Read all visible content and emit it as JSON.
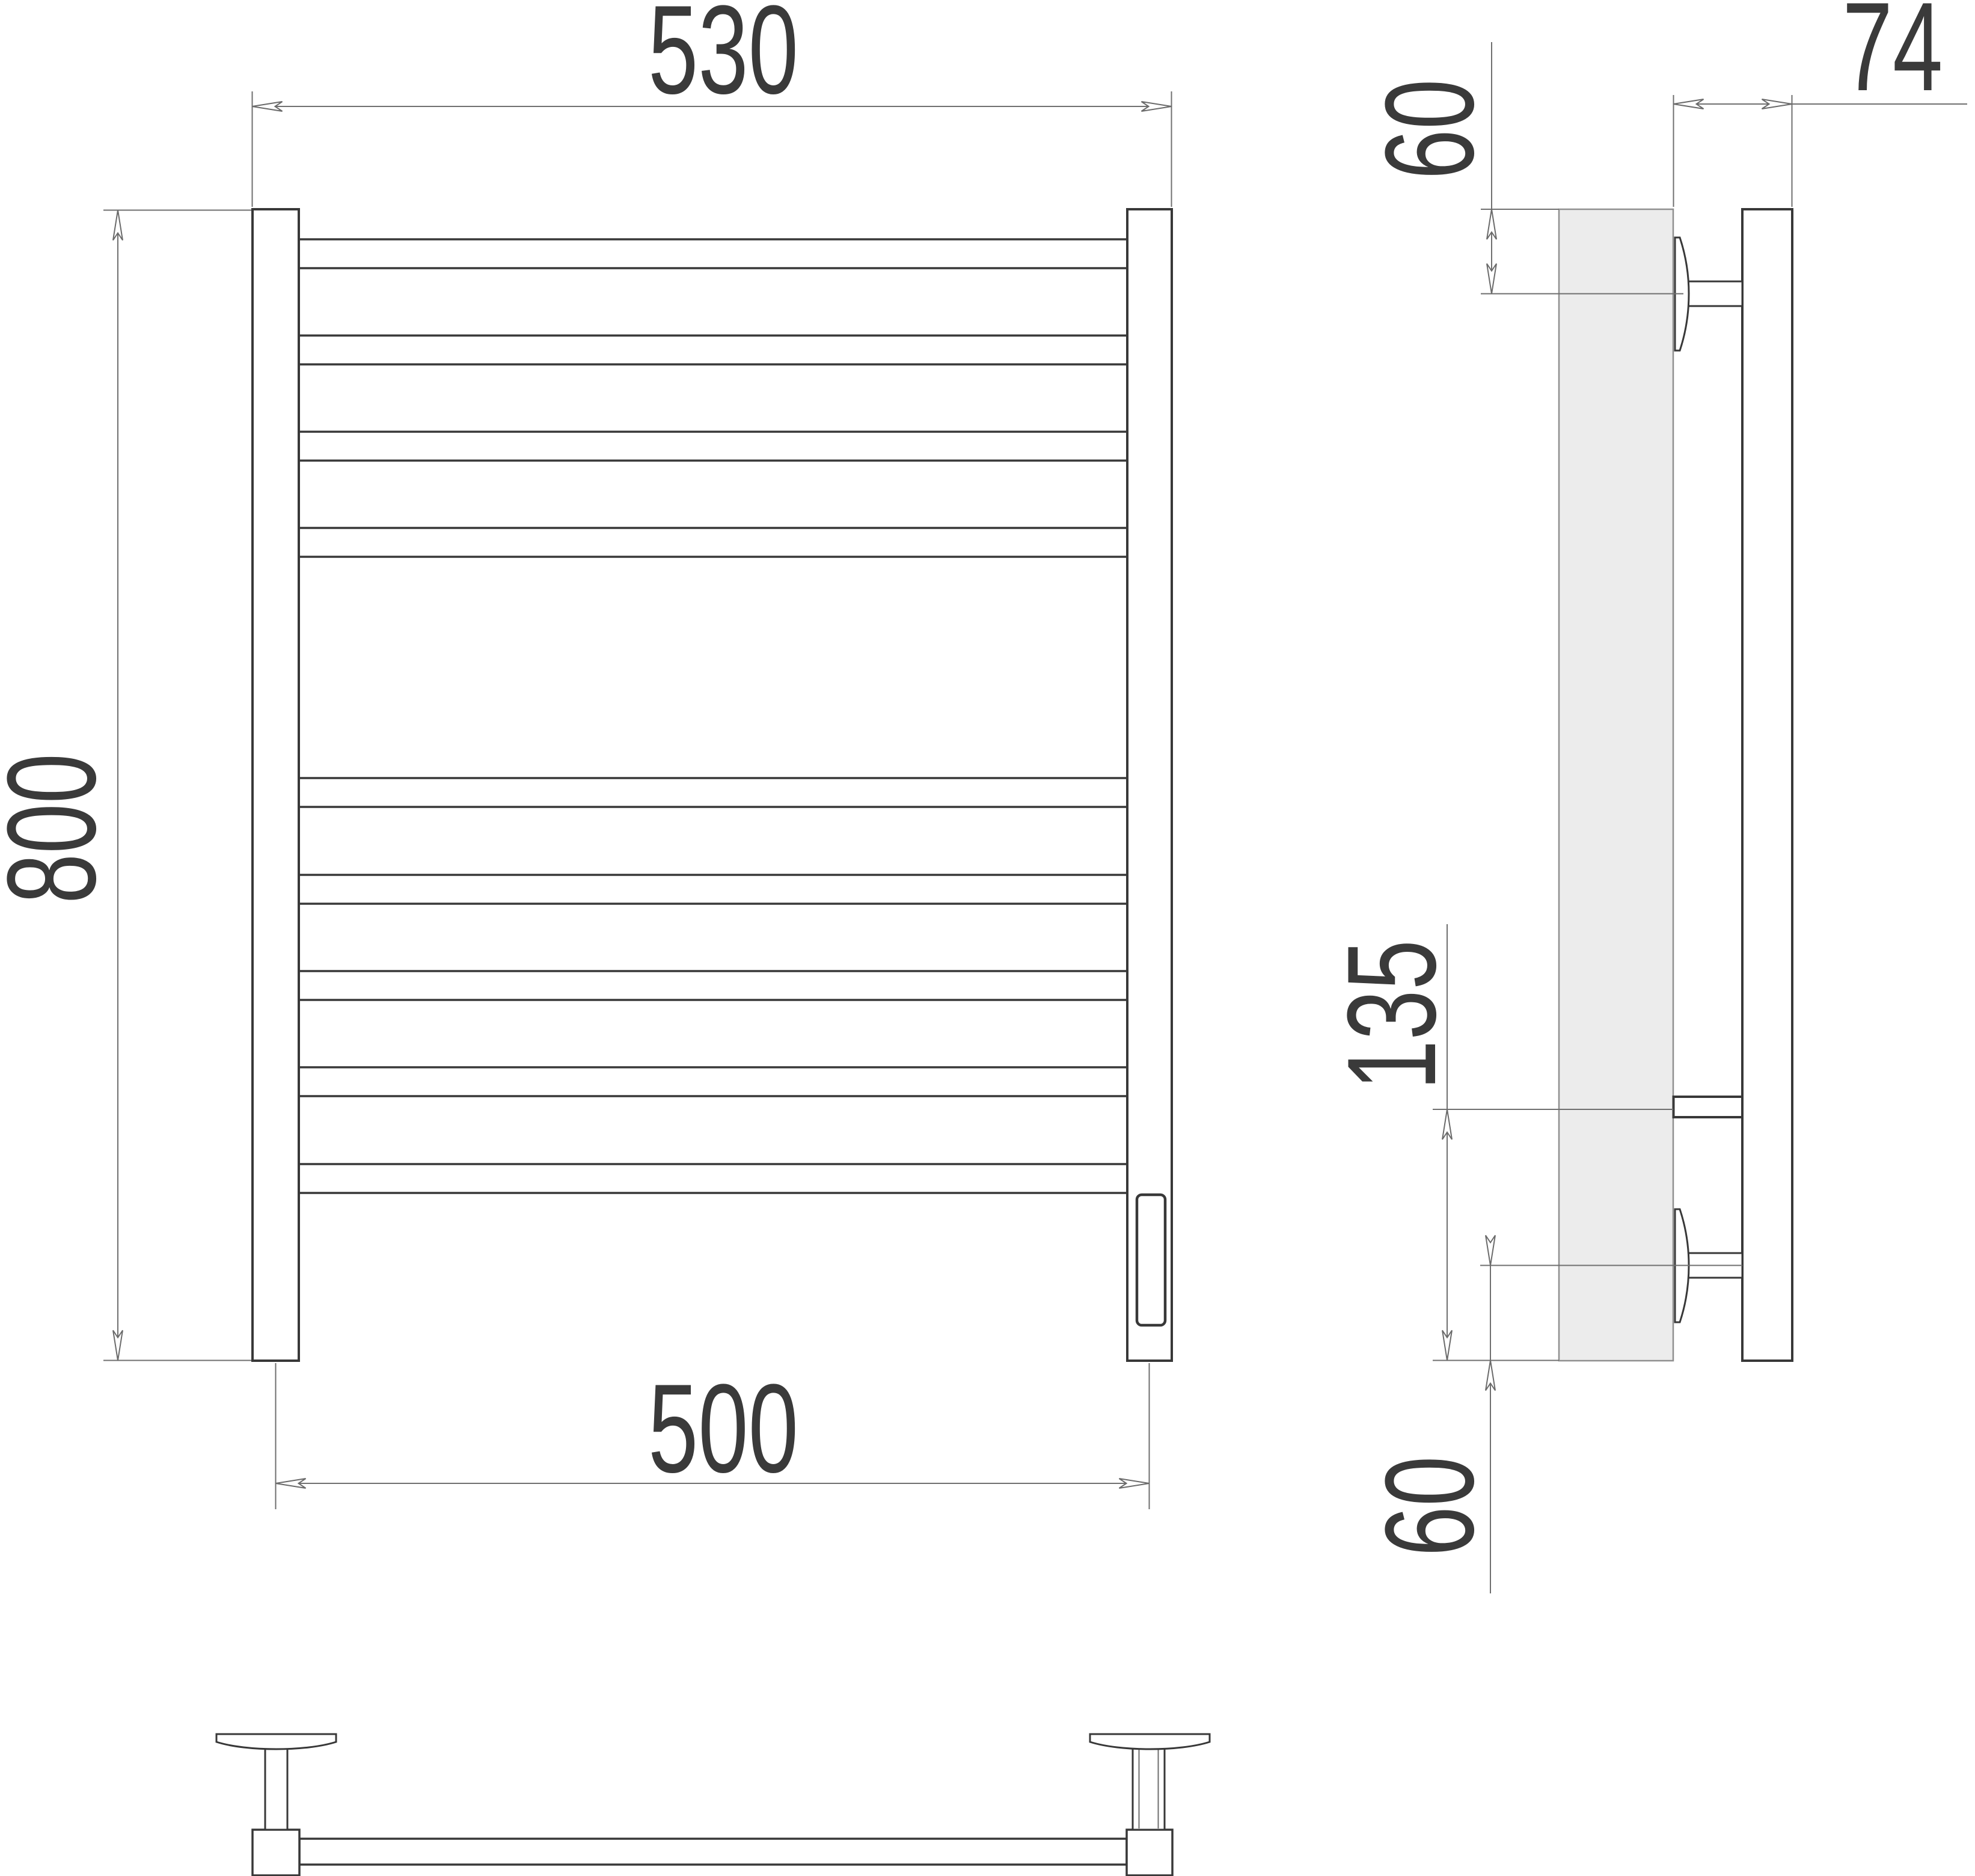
{
  "dimensions": {
    "front": {
      "outer_width": "530",
      "height": "800",
      "mounting_width": "500"
    },
    "side": {
      "depth": "74",
      "top_offset": "60",
      "connection_span": "135",
      "bottom_offset": "60"
    }
  },
  "colors": {
    "outline": "#383838",
    "dimension_line": "#6f6f6f",
    "text": "#3a3a3a",
    "wall_fill": "#ececec",
    "background": "#ffffff"
  }
}
